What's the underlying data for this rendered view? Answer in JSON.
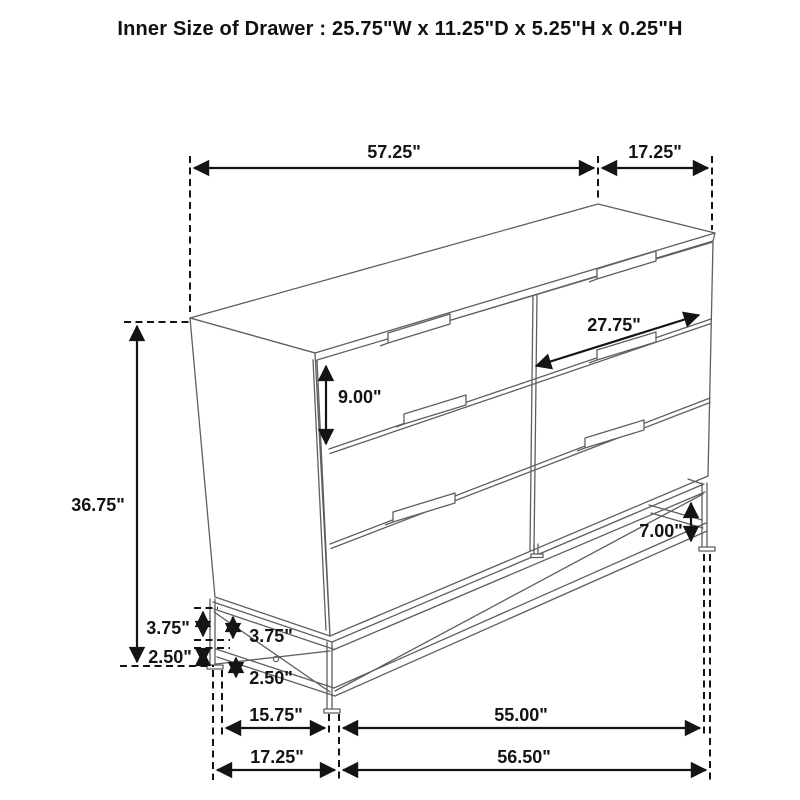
{
  "title": "Inner Size of Drawer : 25.75\"W x 11.25\"D x 5.25\"H x 0.25\"H",
  "dimensions": {
    "top_length": "57.25\"",
    "top_depth": "17.25\"",
    "overall_height": "36.75\"",
    "drawer_front_height": "9.00\"",
    "drawer_front_width": "27.75\"",
    "base_clearance": "7.00\"",
    "left_rail_height_outer": "3.75\"",
    "left_rail_height_inner": "3.75\"",
    "left_foot_height_outer": "2.50\"",
    "left_foot_height_inner": "2.50\"",
    "base_depth_inner": "15.75\"",
    "base_depth_overall": "17.25\"",
    "base_length_inner": "55.00\"",
    "base_length_overall": "56.50\""
  }
}
